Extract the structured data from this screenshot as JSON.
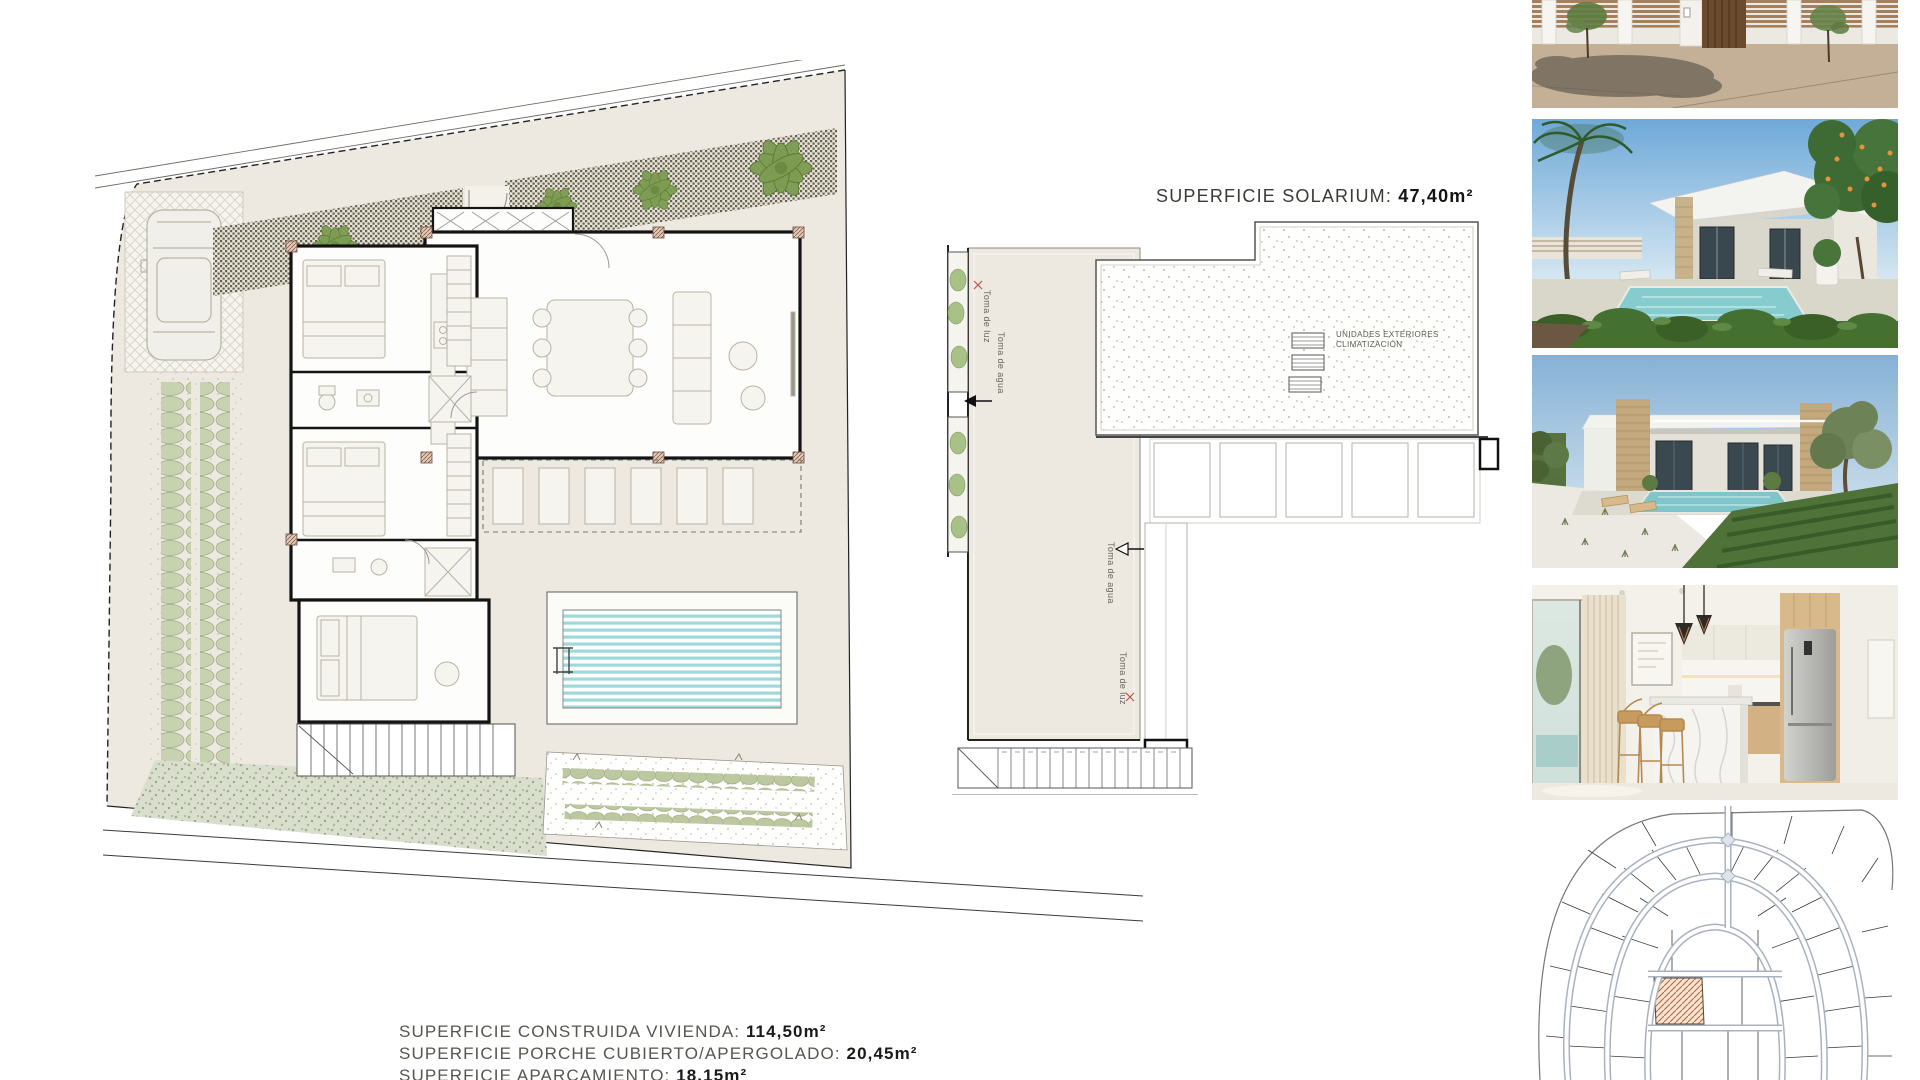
{
  "solarium": {
    "title_label": "SUPERFICIE SOLARIUM:",
    "title_value": "47,40m²",
    "ac_label_line1": "UNIDADES EXTERIORES",
    "ac_label_line2": "CLIMATIZACIÓN",
    "left_labels": {
      "luz": "Toma de luz",
      "agua": "Toma de agua"
    },
    "right_labels": {
      "agua": "Toma de agua",
      "luz": "Toma de luz"
    }
  },
  "surface_summary": {
    "lines": [
      {
        "label": "SUPERFICIE CONSTRUIDA VIVIENDA:",
        "value": "114,50m²"
      },
      {
        "label": "SUPERFICIE PORCHE CUBIERTO/APERGOLADO:",
        "value": "20,45m²"
      },
      {
        "label": "SUPERFICIE APARCAMIENTO:",
        "value": "18,15m²"
      }
    ]
  },
  "photos": {
    "items": [
      {
        "name": "street-entrance-render"
      },
      {
        "name": "villa-pool-garden-render"
      },
      {
        "name": "villa-exterior-render"
      },
      {
        "name": "kitchen-interior-render"
      },
      {
        "name": "urbanization-master-plan"
      }
    ]
  },
  "colors": {
    "plan_fill": "#ede8e0",
    "pool_stripe": "#9ed8da",
    "tree_green": "#7d9c52",
    "hedge_green": "#c7d2b0",
    "hatched_plot": "#b0673a",
    "label_text": "#57554f",
    "value_text": "#1b1a18"
  }
}
